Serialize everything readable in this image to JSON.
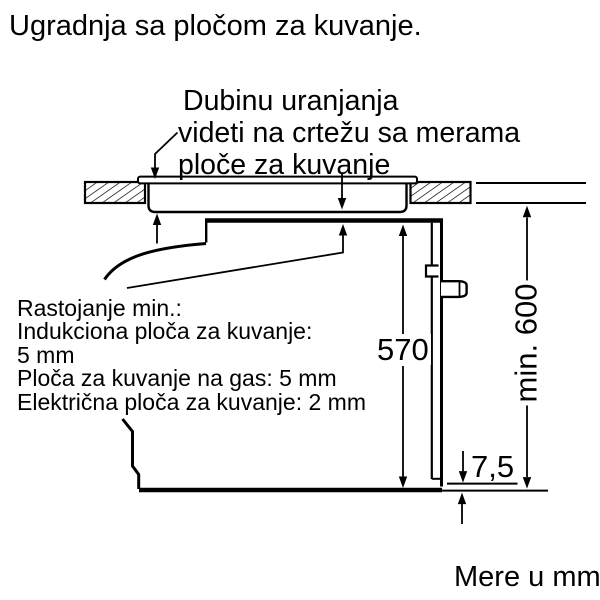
{
  "page": {
    "title": "Ugradnja sa pločom za kuvanje.",
    "footer": "Mere u mm"
  },
  "annotations": {
    "depth_note": {
      "line1": "Dubinu uranjanja",
      "line2": "videti na crtežu sa merama",
      "line3": "ploče za kuvanje"
    },
    "clearance_note": {
      "line1": "Rastojanje min.:",
      "line2": "Indukciona ploča za kuvanje:",
      "line3": "5 mm",
      "line4": "Ploča za kuvanje na gas: 5 mm",
      "line5": "Električna ploča za kuvanje: 2 mm"
    }
  },
  "dimensions": {
    "niche_height": "570",
    "min_installation_height": "min. 600",
    "bottom_offset": "7,5"
  },
  "colors": {
    "line": "#000000",
    "background": "#ffffff"
  }
}
